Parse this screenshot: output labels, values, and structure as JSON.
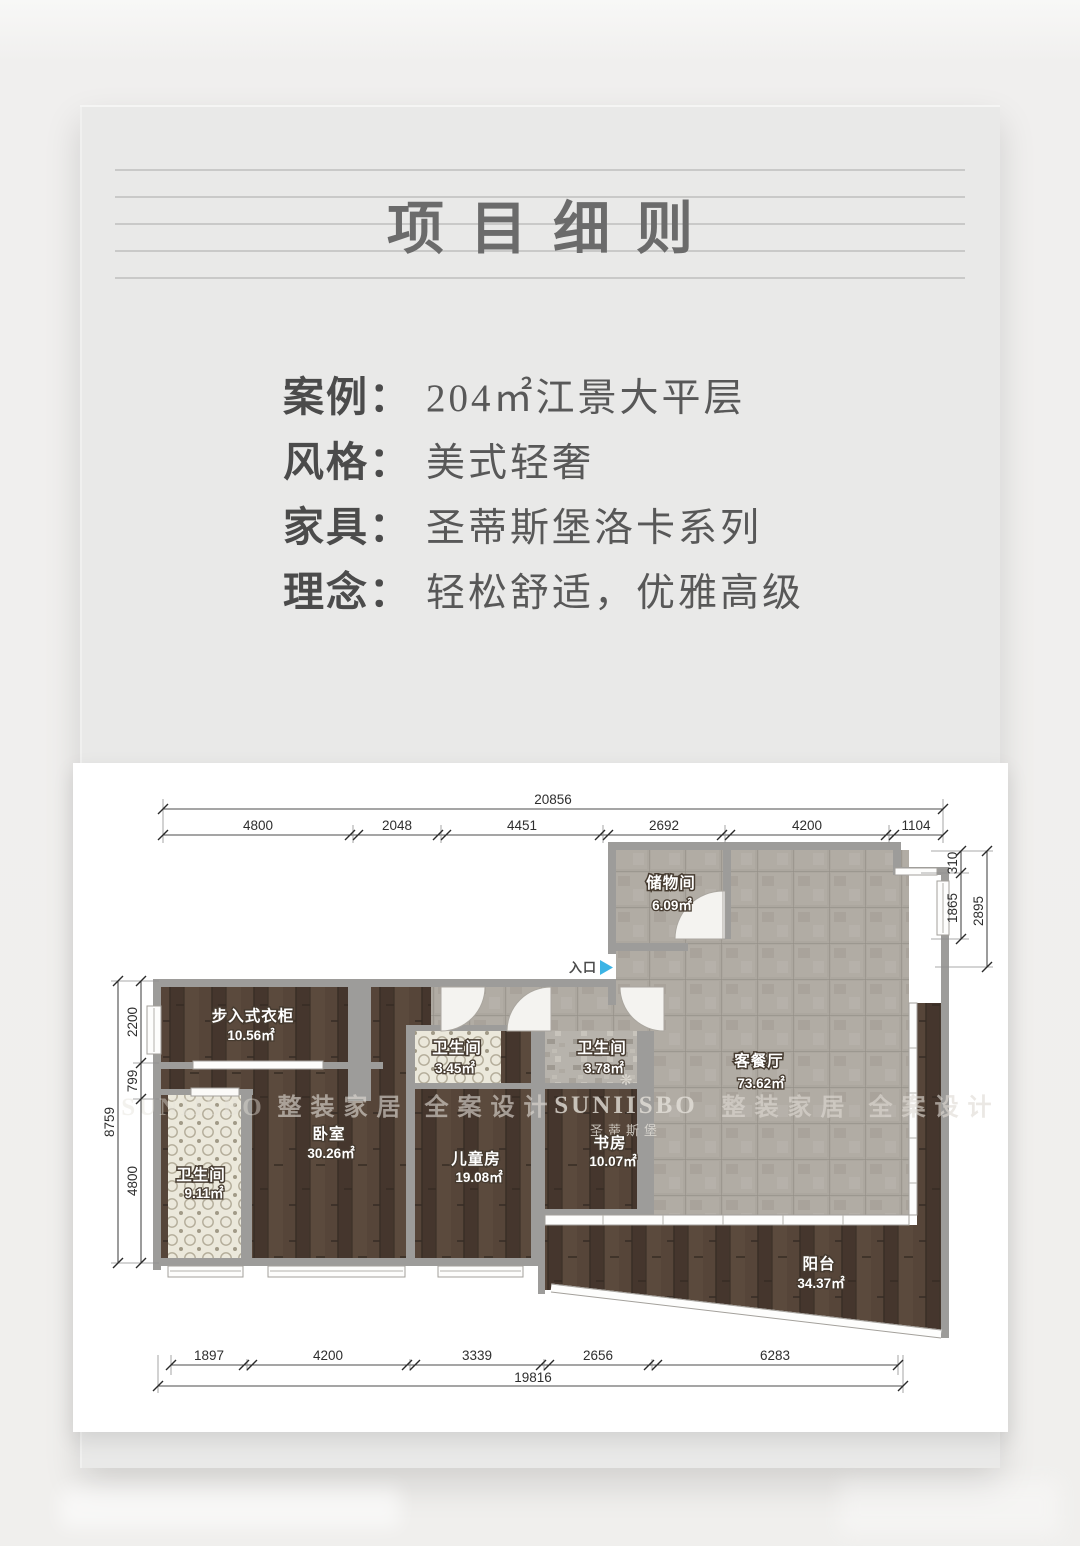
{
  "header": {
    "title": "项目细则"
  },
  "info": {
    "rows": [
      {
        "label": "案例：",
        "value": "204㎡江景大平层"
      },
      {
        "label": "风格：",
        "value": "美式轻奢"
      },
      {
        "label": "家具：",
        "value": "圣蒂斯堡洛卡系列"
      },
      {
        "label": "理念：",
        "value": "轻松舒适，优雅高级"
      }
    ]
  },
  "floorplan": {
    "entrance": {
      "label": "入口"
    },
    "rooms": {
      "storage": {
        "name": "储物间",
        "area": "6.09㎡"
      },
      "living": {
        "name": "客餐厅",
        "area": "73.62㎡"
      },
      "bath_378": {
        "name": "卫生间",
        "area": "3.78㎡"
      },
      "bath_345": {
        "name": "卫生间",
        "area": "3.45㎡"
      },
      "study": {
        "name": "书房",
        "area": "10.07㎡"
      },
      "kids": {
        "name": "儿童房",
        "area": "19.08㎡"
      },
      "bedroom": {
        "name": "卧室",
        "area": "30.26㎡"
      },
      "closet": {
        "name": "步入式衣柜",
        "area": "10.56㎡"
      },
      "bath_911": {
        "name": "卫生间",
        "area": "9.11㎡"
      },
      "balcony": {
        "name": "阳台",
        "area": "34.37㎡"
      }
    },
    "dims": {
      "top_total": "20856",
      "top_segments": [
        "4800",
        "2048",
        "4451",
        "2692",
        "4200",
        "1104"
      ],
      "right_segments": [
        "310",
        "1865"
      ],
      "right_total": "2895",
      "left_total": "8759",
      "left_segments": [
        "2200",
        "799",
        "4800"
      ],
      "bottom_segments": [
        "1897",
        "4200",
        "3339",
        "2656",
        "6283"
      ],
      "bottom_total": "19816"
    },
    "watermarks": {
      "brand": "SUNIISBO",
      "brand_cn": "圣蒂斯堡",
      "slogan": "整装家居 全案设计",
      "plant_icon": "❋"
    }
  },
  "colors": {
    "panel_bg": "#e9e9e8",
    "page_bg": "#f0efed",
    "wood": "#4c3d33",
    "tile": "#aca79f",
    "wall": "#9d9c9a",
    "entrance_arrow": "#3cb4e5",
    "title_text": "#6b6b6b",
    "info_text": "#4b4b4b"
  }
}
